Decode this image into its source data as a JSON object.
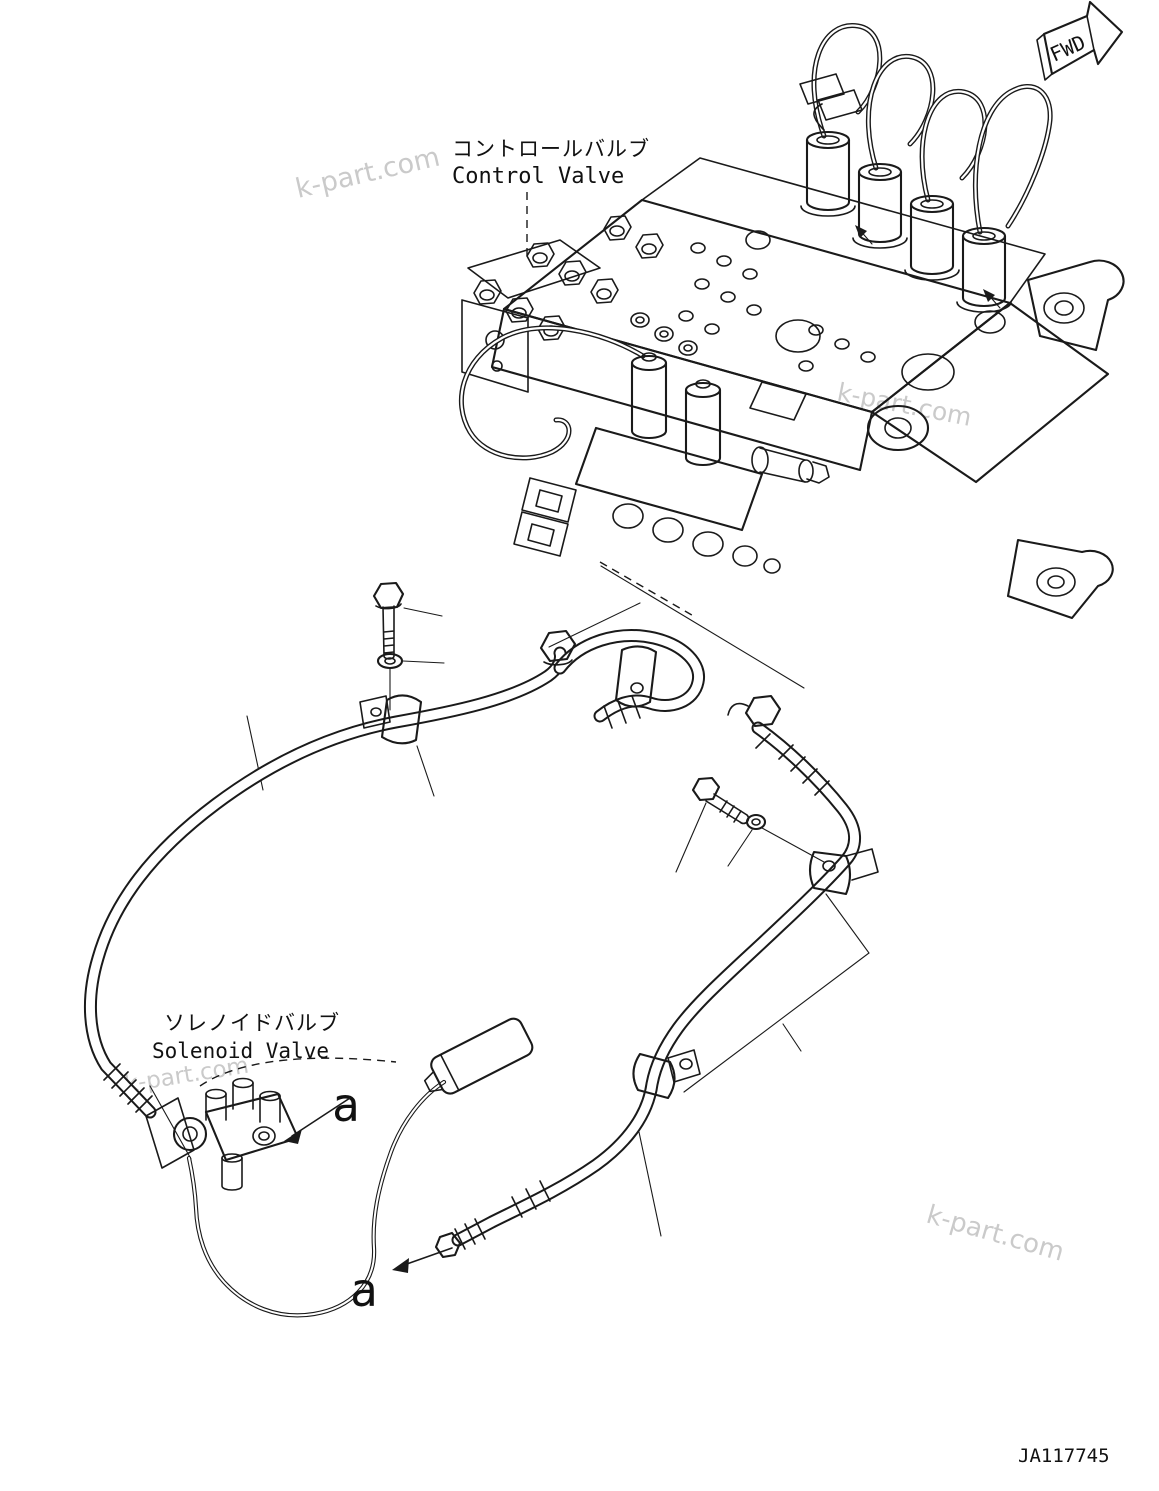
{
  "diagram": {
    "background": "#ffffff",
    "line_color": "#1a1a1a",
    "watermark": {
      "text": "k-part.com",
      "color": "#bdbdbd"
    },
    "direction_indicator": {
      "label": "FWD"
    },
    "labels": {
      "control_valve": {
        "jp": "コントロールバルブ",
        "en": "Control Valve"
      },
      "solenoid_valve": {
        "jp": "ソレノイドバルブ",
        "en": "Solenoid Valve"
      },
      "detail_marker": "a",
      "drawing_number": "JA117745"
    }
  }
}
